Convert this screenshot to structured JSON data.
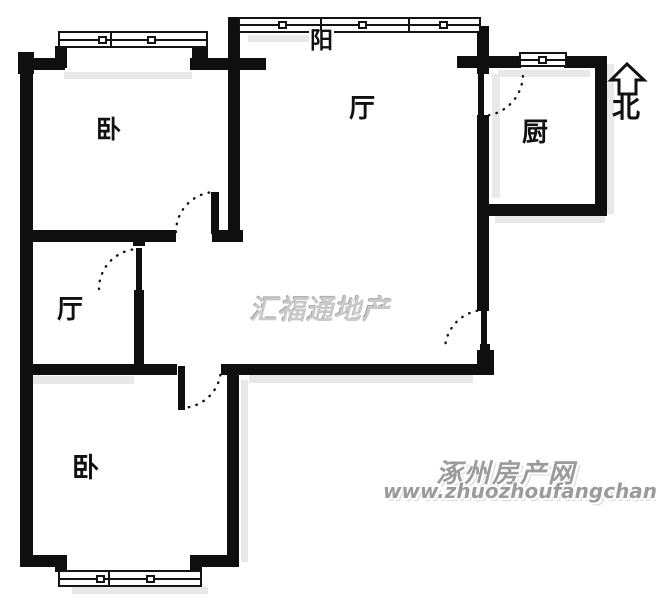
{
  "plan": {
    "labels": {
      "bedroom_top": "卧",
      "living_room": "厅",
      "hall": "厅",
      "kitchen": "厨",
      "bedroom_bottom": "卧",
      "balcony": "阳",
      "north": "北"
    },
    "watermark": {
      "agency": "汇福通地产",
      "site_name": "涿州房产网",
      "site_url": "www.zhuozhoufangchan.com"
    },
    "colors": {
      "wall": "#0f0f0f",
      "background": "#ffffff",
      "shadow": "#e8e8e8",
      "watermark_gray": "#9b9b9b"
    }
  }
}
